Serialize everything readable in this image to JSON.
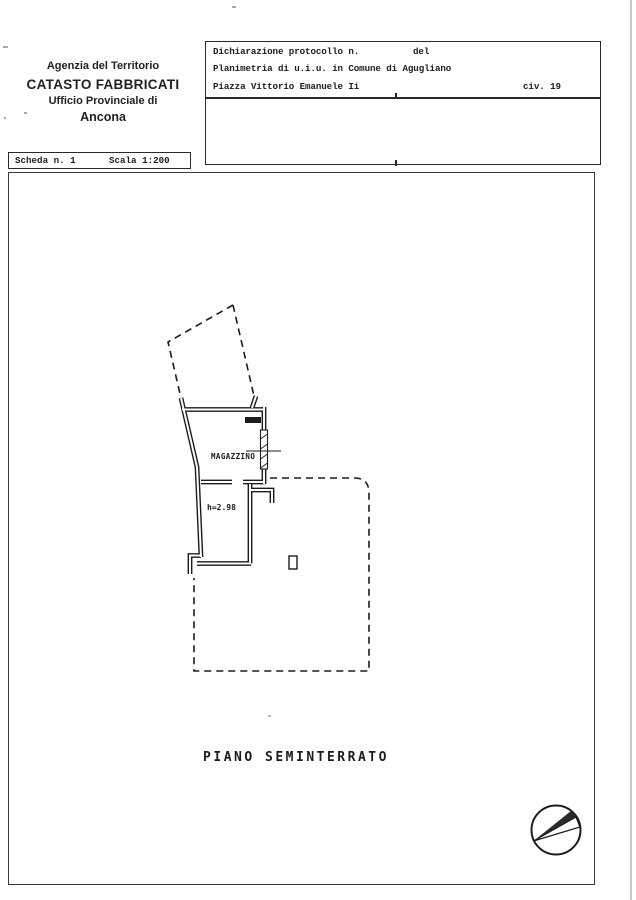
{
  "doc": {
    "header": {
      "line1": "Agenzia del Territorio",
      "line2": "CATASTO FABBRICATI",
      "line3": "Ufficio Provinciale di",
      "line4": "Ancona"
    },
    "declaration": {
      "protocol_label": "Dichiarazione protocollo n.",
      "protocol_number": "",
      "del_label": "del",
      "planimetria_line": "Planimetria di u.i.u. in Comune di Agugliano",
      "address": "Piazza Vittorio Emanuele Ii",
      "civic_label": "civ. 19"
    },
    "scheda": {
      "scheda_label": "Scheda n. 1",
      "scale_label": "Scala 1:200"
    },
    "plan": {
      "room_label": "MAGAZZINO",
      "room_height": "h=2.98",
      "floor_title": "PIANO SEMINTERRATO"
    },
    "icons": {
      "north_arrow": "north-arrow-compass"
    },
    "colors": {
      "ink": "#1c1c1c",
      "paper": "#ffffff"
    }
  }
}
